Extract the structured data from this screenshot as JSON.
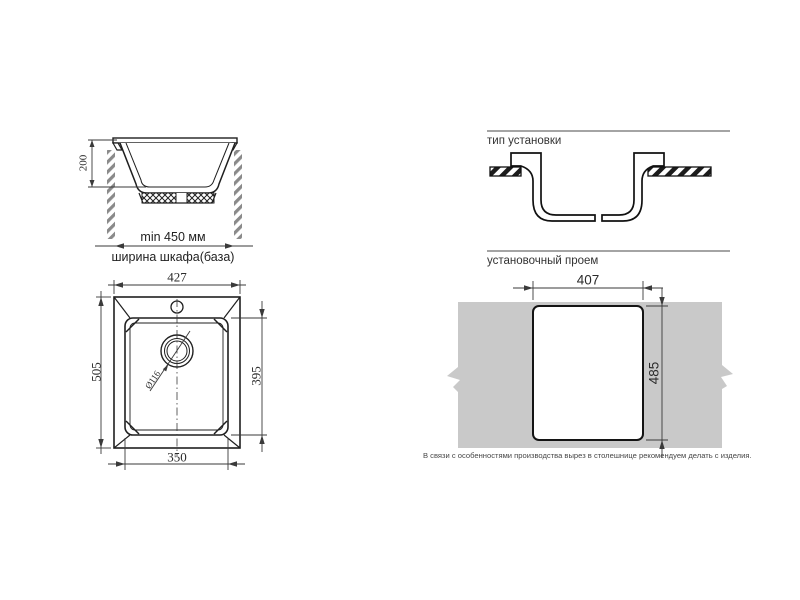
{
  "app": {
    "background": "#ffffff",
    "line_color": "#222222",
    "countertop_gray": "#c9c9c9"
  },
  "section_view": {
    "height_dim": "200",
    "min_width_label": "min 450 мм",
    "cabinet_width_label": "ширина шкафа(база)"
  },
  "installation_type": {
    "title": "тип установки"
  },
  "top_view": {
    "overall_width": "427",
    "overall_height": "505",
    "basin_height": "395",
    "basin_width": "350",
    "drain_diameter": "Ø116"
  },
  "cutout_view": {
    "title": "установочный проем",
    "cutout_width": "407",
    "cutout_height": "485",
    "note": "В связи с особенностями производства вырез в столешнице рекомендуем делать с изделия."
  }
}
